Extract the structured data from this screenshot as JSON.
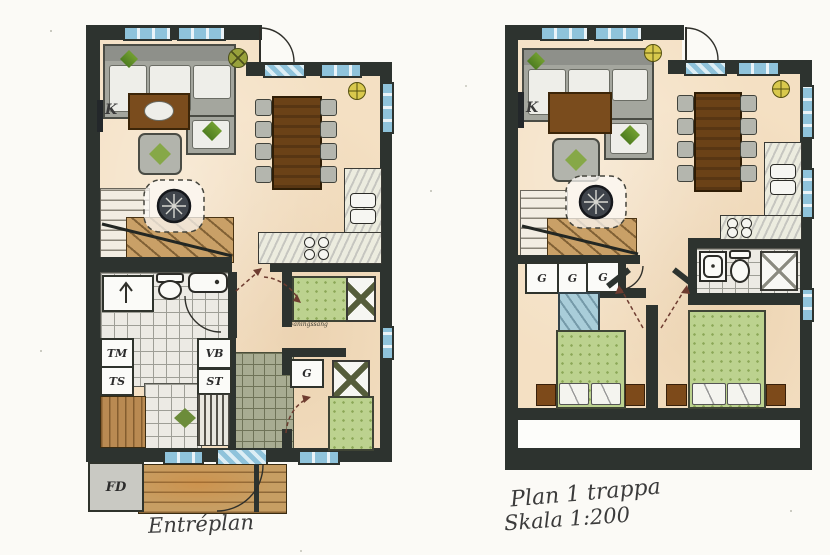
{
  "sheet": {
    "width": 830,
    "height": 555,
    "kind": "hand-drawn architectural floor plans"
  },
  "left_plan": {
    "title": "Entréplan",
    "labels": {
      "tv_marker": "K",
      "washing_machine": "TM",
      "drying_cabinet": "TS",
      "water_heater": "VB",
      "cleaning_cabinet": "ST",
      "wardrobe": "G",
      "entrance_storage": "FD",
      "bed_note": "våningssäng"
    }
  },
  "right_plan": {
    "title": "Plan 1 trappa",
    "scale": "Skala 1:200",
    "labels": {
      "tv_marker": "K",
      "wardrobes": [
        "G",
        "G",
        "G"
      ]
    }
  },
  "colors": {
    "paper": "#fbfaf6",
    "wall": "#2d332f",
    "floor": "#f4e0c3",
    "window_blue": "#8fc3db",
    "bed_green": "#bcd28f",
    "wood_deck": "#c79e63",
    "table_brown": "#6b4217",
    "sofa_gray": "#a4a69e",
    "tile_gray": "#eceae4",
    "tile_olive": "#a8ac92",
    "plant_green": "#6f9c2f",
    "symbol_yellow": "#d9c94d"
  }
}
